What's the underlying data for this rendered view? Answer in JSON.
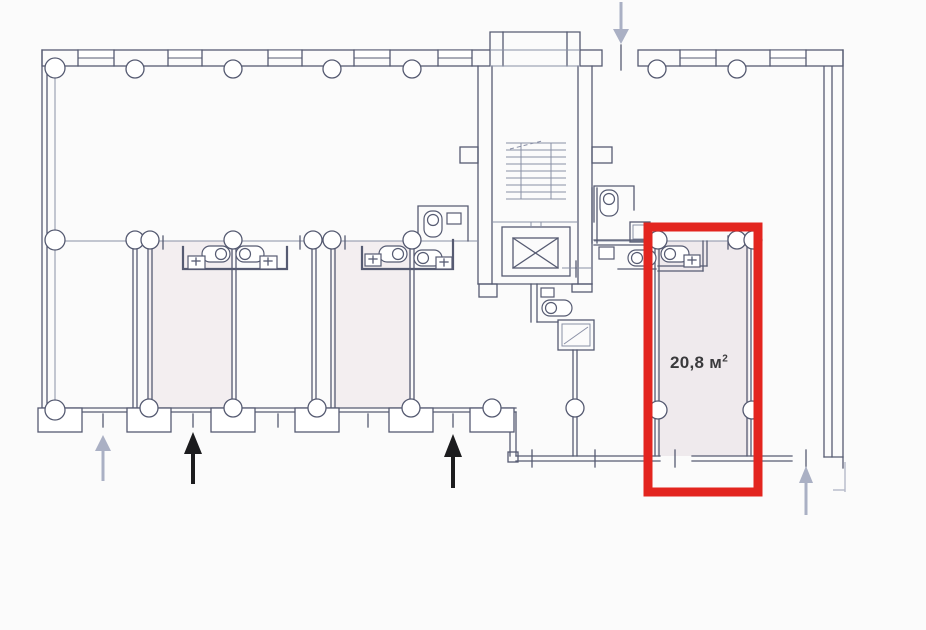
{
  "title": "Building floor plan with highlighted unit",
  "highlighted_unit": {
    "area_label": "20,8 м",
    "area_sup": "2",
    "full_label": "20,8 м²"
  },
  "arrows": [
    {
      "name": "entrance-arrow-gray-left",
      "direction": "up",
      "emphasis": "secondary"
    },
    {
      "name": "entrance-arrow-black-left",
      "direction": "up",
      "emphasis": "primary"
    },
    {
      "name": "entrance-arrow-black-center",
      "direction": "up",
      "emphasis": "primary"
    },
    {
      "name": "entrance-arrow-gray-top",
      "direction": "down",
      "emphasis": "secondary"
    },
    {
      "name": "entrance-arrow-gray-right",
      "direction": "up",
      "emphasis": "secondary"
    }
  ],
  "colors": {
    "background": "#fbfbfb",
    "wall": "#565b72",
    "wall_light": "#8a90a6",
    "faint": "#b6bac9",
    "room_tint": "#f3eef0",
    "highlight_tint": "#efeaed",
    "highlight_red": "#e3251f",
    "arrow_black": "#1c1c1e",
    "arrow_gray": "#aab0c4",
    "label_text": "#3a3a3c"
  }
}
